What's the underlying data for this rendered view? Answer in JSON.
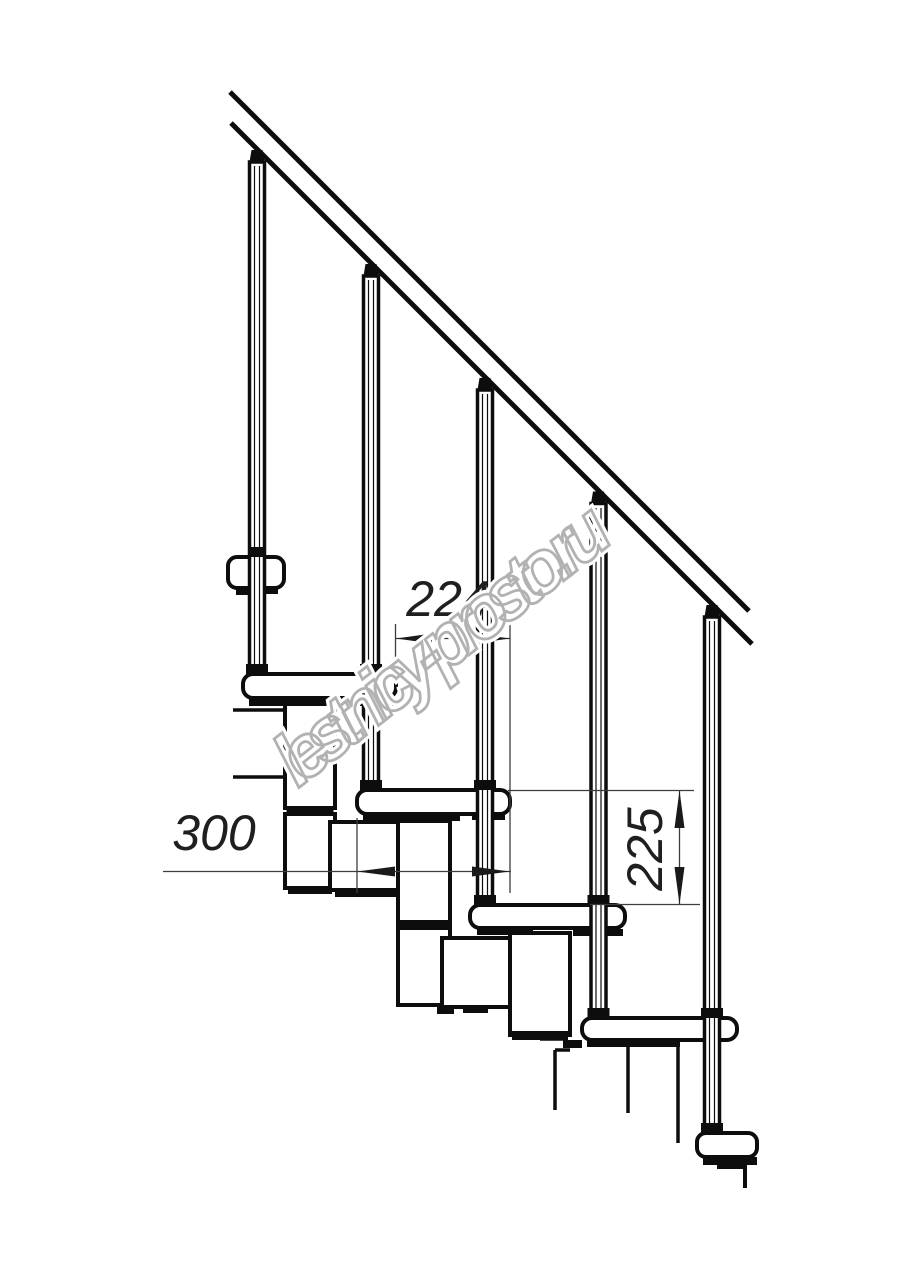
{
  "drawing": {
    "type": "staircase-section-technical-drawing",
    "dimensions": {
      "step_run": {
        "value": "224"
      },
      "tread_width": {
        "value": "300"
      },
      "step_rise": {
        "value": "225"
      }
    },
    "watermark": {
      "text": "lestnicy-prosto.ru",
      "color": "#b2b2b2"
    },
    "colors": {
      "background": "#ffffff",
      "outline": "#0d0d0d",
      "dimension_line": "#3d3d3d",
      "dimension_text": "#1f1f1f"
    }
  }
}
